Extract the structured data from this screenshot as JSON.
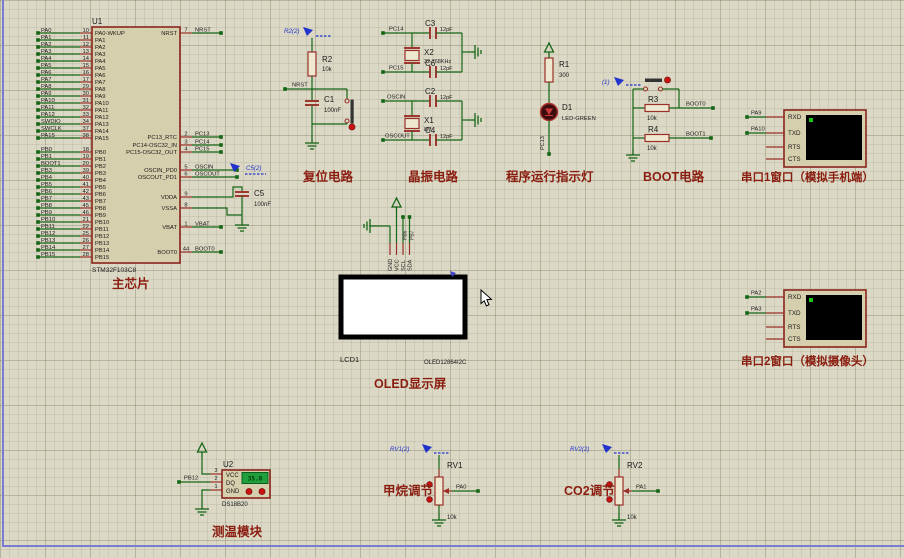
{
  "colors": {
    "wire": "#156515",
    "pin_red": "#9a2f28",
    "component_fill": "#d6cfad",
    "caption_red": "#8b1d10",
    "blue_label": "#2233cc",
    "screen_black": "#000000",
    "screen_cursor": "#19c819",
    "lcd_green": "#1fa03c"
  },
  "chip": {
    "ref": "U1",
    "part": "STM32F103C8",
    "caption": "主芯片",
    "left_pins": [
      {
        "net": "PA0",
        "num": "10",
        "name": "PA0-WKUP"
      },
      {
        "net": "PA1",
        "num": "11",
        "name": "PA1"
      },
      {
        "net": "PA2",
        "num": "12",
        "name": "PA2"
      },
      {
        "net": "PA3",
        "num": "13",
        "name": "PA3"
      },
      {
        "net": "PA4",
        "num": "14",
        "name": "PA4"
      },
      {
        "net": "PA5",
        "num": "15",
        "name": "PA5"
      },
      {
        "net": "PA6",
        "num": "16",
        "name": "PA6"
      },
      {
        "net": "PA7",
        "num": "17",
        "name": "PA7"
      },
      {
        "net": "PA8",
        "num": "29",
        "name": "PA8"
      },
      {
        "net": "PA9",
        "num": "30",
        "name": "PA9"
      },
      {
        "net": "PA10",
        "num": "31",
        "name": "PA10"
      },
      {
        "net": "PA11",
        "num": "32",
        "name": "PA11"
      },
      {
        "net": "PA12",
        "num": "33",
        "name": "PA12"
      },
      {
        "net": "SWDIO",
        "num": "34",
        "name": "PA13"
      },
      {
        "net": "SWCLK",
        "num": "37",
        "name": "PA14"
      },
      {
        "net": "PA15",
        "num": "38",
        "name": "PA15"
      },
      {
        "net": "PB0",
        "num": "18",
        "name": "PB0"
      },
      {
        "net": "PB1",
        "num": "19",
        "name": "PB1"
      },
      {
        "net": "BOOT1",
        "num": "20",
        "name": "PB2"
      },
      {
        "net": "PB3",
        "num": "39",
        "name": "PB3"
      },
      {
        "net": "PB4",
        "num": "40",
        "name": "PB4"
      },
      {
        "net": "PB5",
        "num": "41",
        "name": "PB5"
      },
      {
        "net": "PB6",
        "num": "42",
        "name": "PB6"
      },
      {
        "net": "PB7",
        "num": "43",
        "name": "PB7"
      },
      {
        "net": "PB8",
        "num": "45",
        "name": "PB8"
      },
      {
        "net": "PB9",
        "num": "46",
        "name": "PB9"
      },
      {
        "net": "PB10",
        "num": "21",
        "name": "PB10"
      },
      {
        "net": "PB11",
        "num": "22",
        "name": "PB11"
      },
      {
        "net": "PB12",
        "num": "25",
        "name": "PB12"
      },
      {
        "net": "PB13",
        "num": "26",
        "name": "PB13"
      },
      {
        "net": "PB14",
        "num": "27",
        "name": "PB14"
      },
      {
        "net": "PB15",
        "num": "28",
        "name": "PB15"
      }
    ],
    "right_pins": [
      {
        "name": "NRST",
        "num": "7",
        "net": "NRST"
      },
      {
        "name": "PC13_RTC",
        "num": "2",
        "net": "PC13"
      },
      {
        "name": "PC14-OSC32_IN",
        "num": "3",
        "net": "PC14"
      },
      {
        "name": "PC15-OSC32_OUT",
        "num": "4",
        "net": "PC15"
      },
      {
        "name": "OSCIN_PD0",
        "num": "5",
        "net": "OSCIN"
      },
      {
        "name": "OSCOUT_PD1",
        "num": "6",
        "net": "OSCOUT"
      },
      {
        "name": "VDDA",
        "num": "9",
        "net": ""
      },
      {
        "name": "VSSA",
        "num": "8",
        "net": ""
      },
      {
        "name": "VBAT",
        "num": "1",
        "net": "VBAT"
      },
      {
        "name": "BOOT0",
        "num": "44",
        "net": "BOOT0"
      }
    ]
  },
  "reset": {
    "blue_label": "R2(2)",
    "res_ref": "R2",
    "res_val": "10k",
    "net": "NRST",
    "cap_ref": "C1",
    "cap_val": "100nF",
    "caption": "复位电路"
  },
  "c5": {
    "blue_label": "C5(2)",
    "ref": "C5",
    "val": "100nF"
  },
  "crystal": {
    "caption": "晶振电路",
    "groups": [
      {
        "top_net": "PC14",
        "top_cap": "C3",
        "top_val": "12pF",
        "xref": "X2",
        "xval": "32.768KHz",
        "bot_net": "PC15",
        "bot_cap": "C6",
        "bot_val": "12pF"
      },
      {
        "top_net": "OSCIN",
        "top_cap": "C2",
        "top_val": "12pF",
        "xref": "X1",
        "xval": "8M",
        "bot_net": "OSCOUT",
        "bot_cap": "C4",
        "bot_val": "12pF"
      }
    ]
  },
  "indicator": {
    "res_ref": "R1",
    "res_val": "300",
    "led_ref": "D1",
    "led_val": "LED-GREEN",
    "net": "PC13",
    "caption": "程序运行指示灯"
  },
  "boot": {
    "blue_label": "(1)",
    "r3_ref": "R3",
    "r3_val": "10k",
    "net0": "BOOT0",
    "r4_ref": "R4",
    "r4_val": "10k",
    "net1": "BOOT1",
    "caption": "BOOT电路"
  },
  "terminal1": {
    "nets": [
      "PA9",
      "PA10"
    ],
    "pins": [
      "RXD",
      "TXD",
      "RTS",
      "CTS"
    ],
    "caption": "串口1窗口（模拟手机端）"
  },
  "terminal2": {
    "nets": [
      "PA2",
      "PA3"
    ],
    "pins": [
      "RXD",
      "TXD",
      "RTS",
      "CTS"
    ],
    "caption": "串口2窗口（模拟摄像头）"
  },
  "oled": {
    "ref": "LCD1",
    "part": "OLED12864I2C",
    "caption": "OLED显示屏",
    "pins": [
      "GND",
      "VCC",
      "SCL",
      "SDA"
    ],
    "net_scl": "PB6",
    "net_sda": "PB7"
  },
  "temp": {
    "ref": "U2",
    "part": "DS18B20",
    "display": "35.0",
    "net": "PB12",
    "caption": "测温模块",
    "pins": [
      {
        "num": "3",
        "name": "VCC"
      },
      {
        "num": "2",
        "name": "DQ"
      },
      {
        "num": "1",
        "name": "GND"
      }
    ]
  },
  "rv1": {
    "blue_label": "RV1(2)",
    "ref": "RV1",
    "val": "10k",
    "net": "PA0",
    "caption": "甲烷调节"
  },
  "rv2": {
    "blue_label": "RV2(2)",
    "ref": "RV2",
    "val": "10k",
    "net": "PA1",
    "caption": "CO2调节"
  }
}
